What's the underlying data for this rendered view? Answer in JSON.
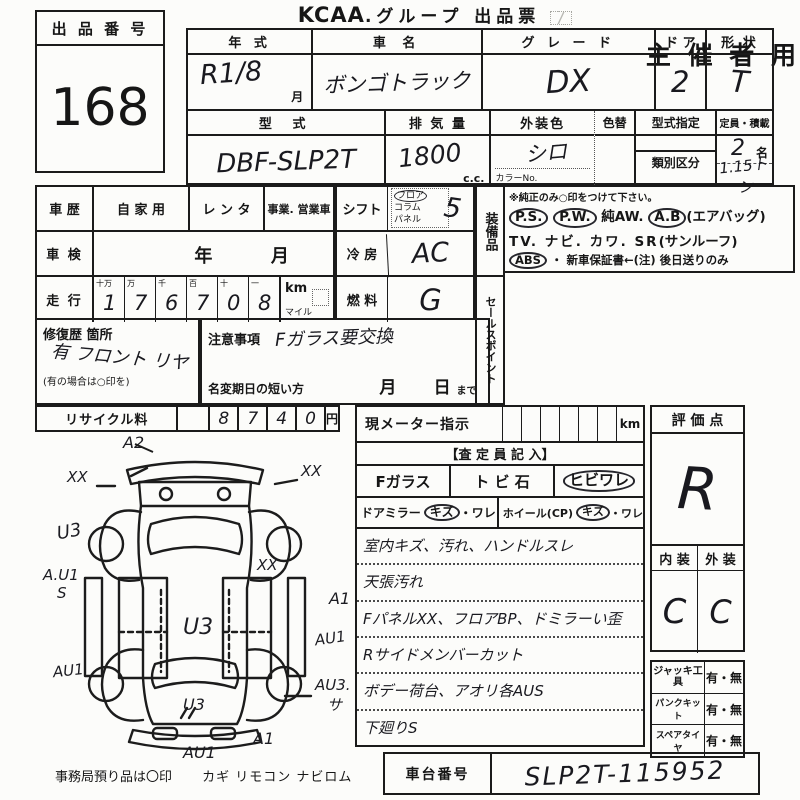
{
  "header": {
    "lot_label": "出 品 番 号",
    "lot_number": "168",
    "brand": "KCAA",
    "title_rest": ".グループ 出品票",
    "organizer": "主 催 者 用"
  },
  "vehicle": {
    "year_label": "年  式",
    "year_value": "R1/8",
    "year_unit": "月",
    "name_label": "車  名",
    "name_value": "ボンゴトラック",
    "grade_label": "グ レ ー ド",
    "grade_value": "DX",
    "doors_label": "ド ア",
    "doors_value": "2",
    "shape_label": "形 状",
    "shape_value": "T",
    "model_label": "型    式",
    "model_value": "DBF-SLP2T",
    "disp_label": "排 気 量",
    "disp_value": "1800",
    "disp_unit": "c.c.",
    "color_label": "外装色",
    "color_value": "シロ",
    "color_no_label": "カラーNo.",
    "color_change_label": "色替",
    "type_desig_label": "型式指定",
    "class_label": "類別区分",
    "capacity_label": "定員・積載",
    "capacity_value": "2",
    "capacity_unit": "名",
    "load_value": "1.15トン"
  },
  "history": {
    "car_history_label": "車 歴",
    "private_label": "自 家 用",
    "rental_label": "レ ン タ",
    "business_label": "事業. 営業車",
    "inspection_label": "車 検",
    "inspection_year": "年",
    "inspection_month": "月",
    "mileage_label": "走 行",
    "digit_headers": [
      "十万",
      "万",
      "千",
      "百",
      "十",
      "一"
    ],
    "mileage_digits": [
      "1",
      "7",
      "6",
      "7",
      "0",
      "8"
    ],
    "unit_km": "km",
    "unit_mile": "マイル",
    "repair_label": "修復歴 箇所",
    "repair_value": "有 フロント リヤ",
    "repair_note": "(有の場合は○印を)",
    "caution_label": "注意事項",
    "caution_value": "Fガラス要交換",
    "name_change_label": "名変期日の短い方",
    "name_change_month": "月",
    "name_change_day": "日",
    "name_change_suffix": "まで",
    "recycle_label": "リサイクル料",
    "recycle_digits": [
      "8",
      "7",
      "4",
      "0"
    ],
    "recycle_unit": "円"
  },
  "specs": {
    "shift_label": "シフト",
    "shift_floor": "フロア",
    "shift_column": "コラム",
    "shift_panel": "パネル",
    "shift_value": "5",
    "ac_label": "冷 房",
    "ac_value": "AC",
    "fuel_label": "燃 料",
    "fuel_value": "G"
  },
  "equipment": {
    "label_vertical": "装備品",
    "sales_label_vertical": "セールスポイント",
    "note": "※純正のみ○印をつけて下さい。",
    "ps": "P.S.",
    "pw": "P.W.",
    "aw": "純AW.",
    "ab": "A.B",
    "ab_note": "(エアバッグ)",
    "tv": "TV.",
    "navi": "ナビ.",
    "kawa": "カワ.",
    "sr": "SR",
    "sr_note": "(サンルーフ)",
    "abs": "ABS",
    "warranty": "・ 新車保証書←(注) 後日送りのみ"
  },
  "inspector": {
    "meter_label": "現メーター指示",
    "meter_unit": "km",
    "entry_header": "【査 定 員 記 入】",
    "fglass_label": "Fガラス",
    "fglass_opt1": "ト ビ 石",
    "fglass_opt2": "ヒビワレ",
    "mirror_label": "ドアミラー",
    "mirror_opt1": "キズ",
    "mirror_opt2": "・ワレ",
    "wheel_label": "ホイール(CP)",
    "wheel_opt1": "キズ",
    "wheel_opt2": "・ワレ",
    "notes": [
      "室内キズ、汚れ、ハンドルスレ",
      "天張汚れ",
      "FパネルXX、フロアBP、ドミラーい歪",
      "Rサイドメンバーカット",
      "ボデー荷台、アオリ各AUS",
      "下廻りS"
    ]
  },
  "rating": {
    "label": "評 価 点",
    "value": "R",
    "interior_label": "内 装",
    "exterior_label": "外 装",
    "interior_value": "C",
    "exterior_value": "C"
  },
  "accessories": {
    "rows": [
      {
        "label": "ジャッキ工具",
        "value": "有・無"
      },
      {
        "label": "パンクキット",
        "value": "有・無"
      },
      {
        "label": "スペアタイヤ",
        "value": "有・無"
      }
    ]
  },
  "chassis": {
    "label": "車台番号",
    "value": "SLP2T-115952"
  },
  "footer": {
    "office_note": "事務局預り品は〇印",
    "items": "カギ リモコン ナビロム"
  },
  "diagram": {
    "a2": "A2",
    "xx_front_left": "XX",
    "xx_front_right": "XX",
    "u3_left": "U3",
    "au1_s_left": "A.U1",
    "s_left": "S",
    "xx_bed": "XX",
    "u3_bed": "U3",
    "a1_right": "A1",
    "au1_right": "AU1",
    "au1_left": "AU1",
    "au3_right": "AU3.",
    "sa_right": "サ",
    "u3_rear": "U3",
    "a1_rear": "A1",
    "au1_rear": "AU1",
    "hatch": "〃"
  }
}
